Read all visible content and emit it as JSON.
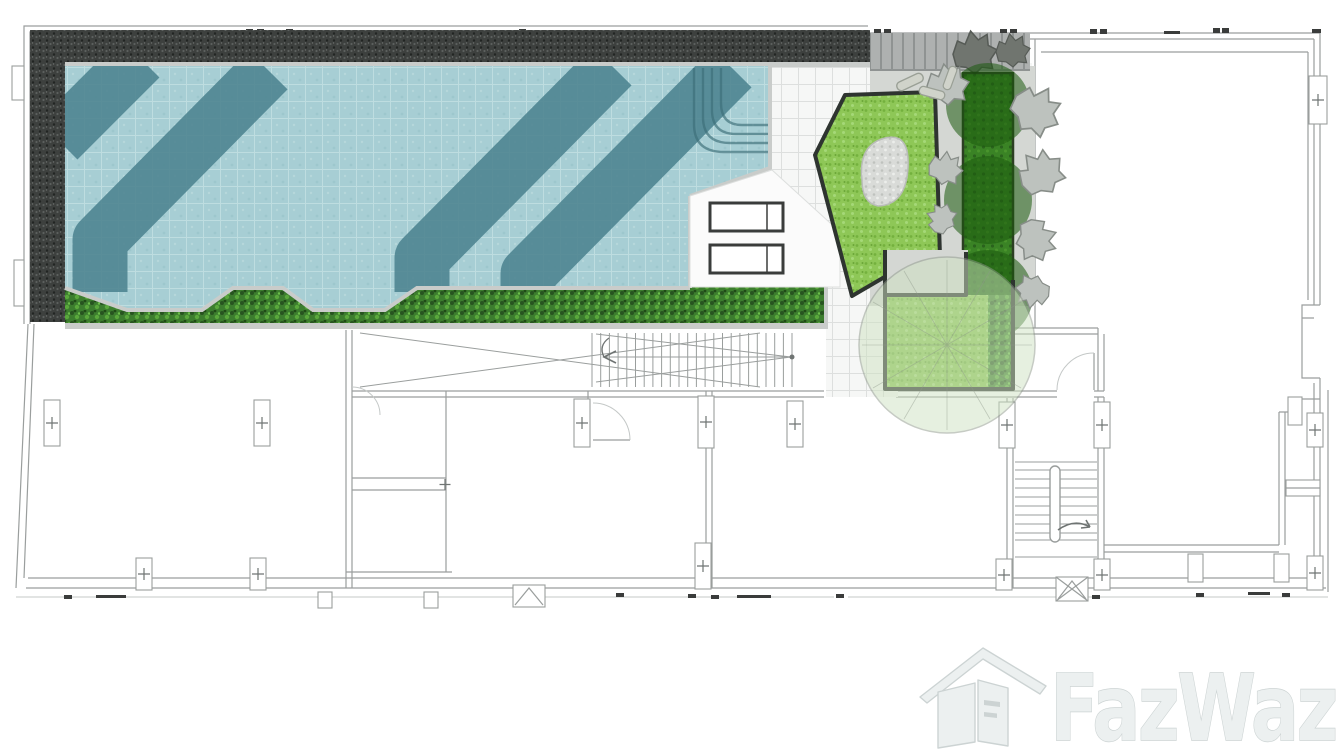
{
  "page": {
    "width": 1342,
    "height": 754,
    "background": "#ffffff",
    "description_visible_text_count": 1
  },
  "watermark": {
    "brand": "FazWaz",
    "icon": "house-logo-icon"
  },
  "colors": {
    "wall": "#9a9e9d",
    "wall_light": "#c4c8c7",
    "wall_dark": "#6f7473",
    "tick": "#3a3c3b",
    "charcoal": "#3d403e",
    "charcoal_speck_light": "#5c605e",
    "charcoal_speck_dark": "#222523",
    "water": "#a7ced4",
    "water_grid": "#c8e4e6",
    "pool_stripe": "#4f8591",
    "coping": "#c9ccca",
    "coping_edge": "#9aa09f",
    "deck_tile": "#f6f7f6",
    "tile_line": "#dddfde",
    "plain_deck": "#fbfbfb",
    "hedge": "#3c7d2e",
    "hedge_dark": "#275420",
    "hedge_light": "#5aા"
  },
  "colors_fix_note": "see colors2",
  "colors2": {
    "hedge_light": "#5aa83c",
    "lawn": "#8ec757",
    "lawn_dark": "#74b13d",
    "lawn_border": "#2e3430",
    "pebble": "#d9dbd8",
    "pebble_dot": "#bfc2be",
    "path_gray": "#d4d7d3",
    "stripe_deck": "#aeb1b0",
    "stripe_deck_line": "#8f9392",
    "planter": "#2e7c17",
    "planter_dark": "#1c5a0e",
    "planter_border": "#1e3315",
    "tree_gray": "#bdc2be",
    "tree_gray_dark": "#878d88",
    "tree_dark_top": "#70756f",
    "canopy_fill": "#cfe2c2",
    "canopy_edge": "#8e988a",
    "log_fill": "#d0d3ca",
    "log_edge": "#9aa096",
    "logo_fill": "#ecf0f0",
    "logo_stroke": "#ccd3d3"
  },
  "plan": {
    "type": "architectural-floor-plan",
    "features": [
      {
        "name": "swimming-pool",
        "style": "tiled water with three curved dark lane stripes and corner entry steps"
      },
      {
        "name": "pool-border-charcoal",
        "style": "dark stone band along top and left of pool"
      },
      {
        "name": "pool-hedge-strip",
        "style": "green hedge below pool with two water inlets"
      },
      {
        "name": "sun-loungers",
        "count": 2
      },
      {
        "name": "timber-deck-striped",
        "style": "grey plank deck top right of pool"
      },
      {
        "name": "lawn-pentagon",
        "style": "bright lawn island with pebble patch"
      },
      {
        "name": "planter-strip-with-trees",
        "style": "dark green planter flanked by grey sculptural trees"
      },
      {
        "name": "lawn-square-planter",
        "style": "square lawn with hedge edge and large tree canopy circle"
      },
      {
        "name": "main-staircase",
        "style": "long corridor stair with cross bracing and direction arrow"
      },
      {
        "name": "rear-staircase",
        "style": "small stair lower right with up arrow"
      },
      {
        "name": "door-swings",
        "count": 3
      },
      {
        "name": "column-markers",
        "style": "small boxes with plus signs along walls"
      }
    ]
  }
}
